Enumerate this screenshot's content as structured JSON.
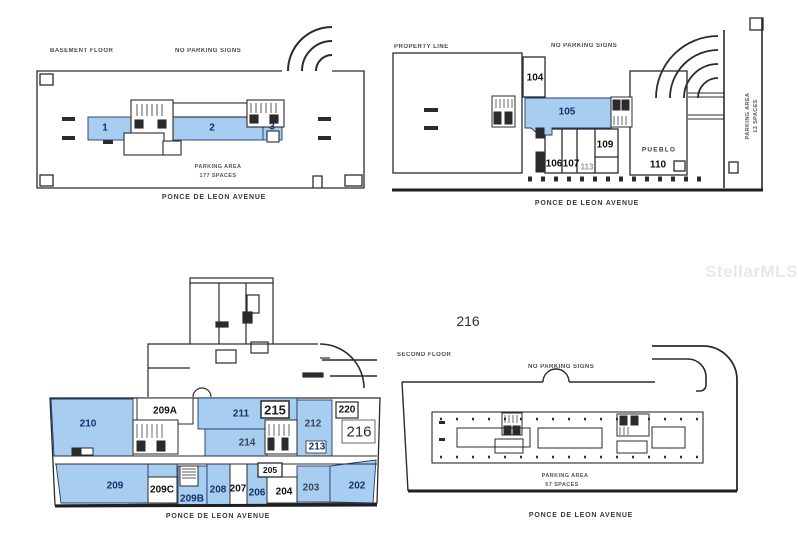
{
  "watermark": "StellarMLS",
  "annotations": {
    "unit_216": "216"
  },
  "colors": {
    "highlight": "#a7cdf0",
    "ink": "#2b2b2b",
    "unit_text": "#16306b"
  },
  "plans": {
    "basement": {
      "heading_left": "BASEMENT FLOOR",
      "heading_right": "NO PARKING SIGNS",
      "parking_line1": "PARKING AREA",
      "parking_line2": "177 SPACES",
      "street": "PONCE DE LEON AVENUE",
      "units": {
        "u1": "1",
        "u2": "2",
        "u3": "3"
      }
    },
    "first": {
      "heading_left": "PROPERTY LINE",
      "heading_right": "NO PARKING SIGNS",
      "parking_line1": "PARKING AREA",
      "parking_line2": "13 SPACES",
      "street": "PONCE DE LEON AVENUE",
      "units": {
        "u104": "104",
        "u105": "105",
        "u106": "106",
        "u107": "107",
        "u113": "113",
        "u109": "109",
        "pueblo": "PUEBLO",
        "u110": "110"
      }
    },
    "second": {
      "street": "PONCE DE LEON AVENUE",
      "units": {
        "u210": "210",
        "u209A": "209A",
        "u211": "211",
        "u215": "215",
        "u214": "214",
        "u212": "212",
        "u213": "213",
        "u220": "220",
        "u216": "216",
        "u209": "209",
        "u209C": "209C",
        "u209B": "209B",
        "u208": "208",
        "u207": "207",
        "u206": "206",
        "u205": "205",
        "u204": "204",
        "u203": "203",
        "u202": "202"
      }
    },
    "parking_level": {
      "heading_left": "SECOND FLOOR",
      "heading_center": "NO PARKING SIGNS",
      "parking_line1": "PARKING AREA",
      "parking_line2": "57 SPACES",
      "street": "PONCE DE LEON AVENUE"
    }
  }
}
